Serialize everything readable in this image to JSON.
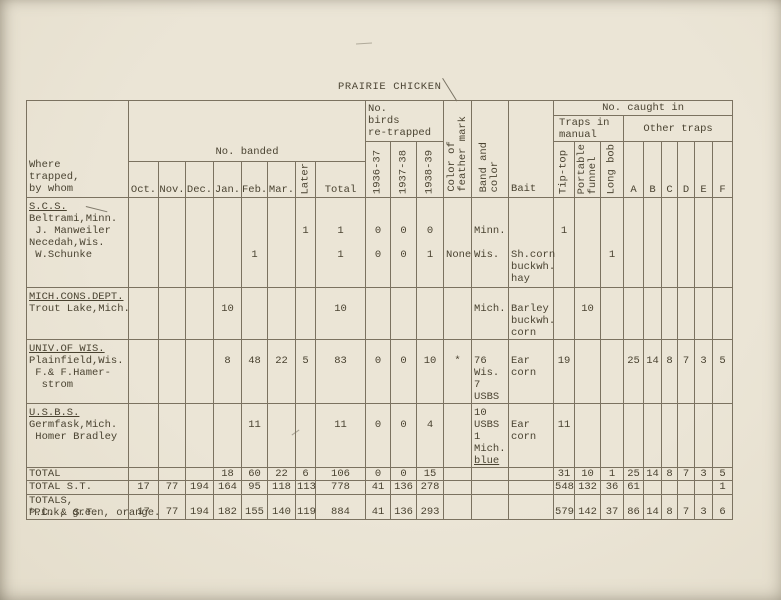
{
  "page": {
    "title": "PRAIRIE CHICKEN",
    "footnote": "*Pink, green, orange.",
    "paper_color": "#e9e3d3",
    "ink_color": "#4a4331",
    "line_color": "#7b7260"
  },
  "table": {
    "header": {
      "where_lines": [
        "Where",
        "trapped,",
        "by whom"
      ],
      "no_banded": "No. banded",
      "months": [
        "Oct.",
        "Nov.",
        "Dec.",
        "Jan.",
        "Feb.",
        "Mar."
      ],
      "later": "Later",
      "total": "Total",
      "retrapped_lines": [
        "No.",
        "birds",
        "re-trapped"
      ],
      "years": [
        "1936-37",
        "1937-38",
        "1938-39"
      ],
      "feather_mark": "Color of\nfeather mark",
      "band_color": "Band and\ncolor",
      "bait": "Bait",
      "no_caught_in": "No. caught in",
      "manual_lines": [
        "Traps in",
        "manual"
      ],
      "other_traps": "Other traps",
      "tip_top": "Tip-top",
      "portable_funnel": "Portable\nfunnel",
      "long_bob": "Long bob",
      "other_cols": [
        "A",
        "B",
        "C",
        "D",
        "E",
        "F"
      ]
    },
    "rows": {
      "scs": {
        "where": [
          "S.C.S.",
          "Beltrami,Minn.",
          " J. Manweiler",
          "Necedah,Wis.",
          " W.Schunke"
        ],
        "feb": [
          "",
          "",
          "",
          "",
          "1"
        ],
        "later": [
          "",
          "",
          "1"
        ],
        "total": [
          "",
          "",
          "1",
          "",
          "1"
        ],
        "y1936_37": [
          "",
          "",
          "0",
          "",
          "0"
        ],
        "y1937_38": [
          "",
          "",
          "0",
          "",
          "0"
        ],
        "y1938_39": [
          "",
          "",
          "0",
          "",
          "1"
        ],
        "feather": [
          "",
          "",
          "",
          "",
          "None"
        ],
        "band": [
          "",
          "",
          "Minn.",
          "",
          "Wis."
        ],
        "bait": [
          "",
          "",
          "",
          "",
          "Sh.corn",
          "buckwh.",
          "hay"
        ],
        "tip_top": [
          "",
          "",
          "1"
        ],
        "long_bob": [
          "",
          "",
          "",
          "",
          "1"
        ]
      },
      "mich": {
        "where": [
          "MICH.CONS.DEPT.",
          "Trout Lake,Mich."
        ],
        "jan": [
          "",
          "10"
        ],
        "total": [
          "",
          "10"
        ],
        "band": [
          "",
          "Mich."
        ],
        "bait": [
          "",
          "Barley",
          "buckwh.",
          "corn"
        ],
        "portable": [
          "",
          "10"
        ]
      },
      "univ": {
        "where": [
          "UNIV.OF WIS.",
          "Plainfield,Wis.",
          " F.& F.Hamer-",
          "  strom"
        ],
        "jan": [
          "",
          "8"
        ],
        "feb": [
          "",
          "48"
        ],
        "mar": [
          "",
          "22"
        ],
        "later": [
          "",
          "5"
        ],
        "total": [
          "",
          "83"
        ],
        "y1936_37": [
          "",
          "0"
        ],
        "y1937_38": [
          "",
          "0"
        ],
        "y1938_39": [
          "",
          "10"
        ],
        "feather": [
          "",
          "*"
        ],
        "band": [
          "",
          "76",
          "Wis.",
          "7",
          "USBS"
        ],
        "bait": [
          "",
          "Ear",
          "corn"
        ],
        "tip_top": [
          "",
          "19"
        ],
        "a": [
          "",
          "25"
        ],
        "b": [
          "",
          "14"
        ],
        "c": [
          "",
          "8"
        ],
        "d": [
          "",
          "7"
        ],
        "e": [
          "",
          "3"
        ],
        "f": [
          "",
          "5"
        ]
      },
      "usbs": {
        "where": [
          "U.S.B.S.",
          "Germfask,Mich.",
          " Homer Bradley"
        ],
        "feb": [
          "",
          "11"
        ],
        "total": [
          "",
          "11"
        ],
        "y1936_37": [
          "",
          "0"
        ],
        "y1937_38": [
          "",
          "0"
        ],
        "y1938_39": [
          "",
          "4"
        ],
        "band": [
          "10",
          "USBS",
          "1",
          "Mich.",
          "blue"
        ],
        "bait": [
          "",
          "Ear",
          "corn"
        ],
        "tip_top": [
          "",
          "11"
        ]
      },
      "total": {
        "where": "TOTAL",
        "jan": "18",
        "feb": "60",
        "mar": "22",
        "later": "6",
        "total": "106",
        "y1936_37": "0",
        "y1937_38": "0",
        "y1938_39": "15",
        "tip_top": "31",
        "portable": "10",
        "long_bob": "1",
        "a": "25",
        "b": "14",
        "c": "8",
        "d": "7",
        "e": "3",
        "f": "5"
      },
      "total_st": {
        "where": "TOTAL S.T.",
        "oct": "17",
        "nov": "77",
        "dec": "194",
        "jan": "164",
        "feb": "95",
        "mar": "118",
        "later": "113",
        "total": "778",
        "y1936_37": "41",
        "y1937_38": "136",
        "y1938_39": "278",
        "tip_top": "548",
        "portable": "132",
        "long_bob": "36",
        "a": "61",
        "f": "1"
      },
      "totals_pc_st": {
        "where": [
          "TOTALS,",
          "P.C. & S.T."
        ],
        "oct": "17",
        "nov": "77",
        "dec": "194",
        "jan": "182",
        "feb": "155",
        "mar": "140",
        "later": "119",
        "total": "884",
        "y1936_37": "41",
        "y1937_38": "136",
        "y1938_39": "293",
        "tip_top": "579",
        "portable": "142",
        "long_bob": "37",
        "a": "86",
        "b": "14",
        "c": "8",
        "d": "7",
        "e": "3",
        "f": "6"
      }
    }
  }
}
